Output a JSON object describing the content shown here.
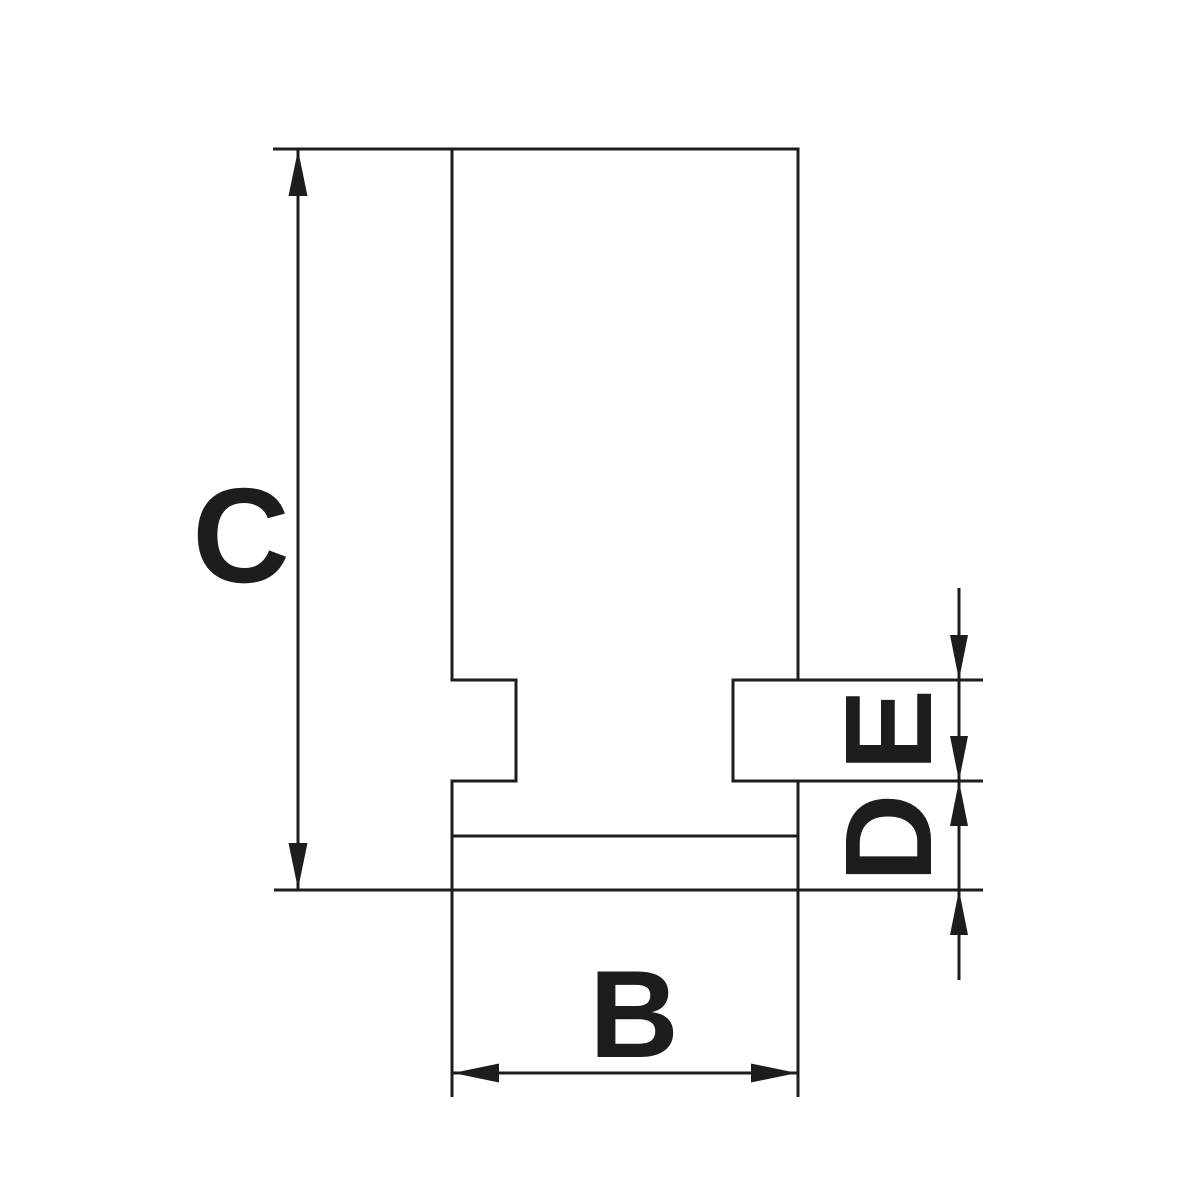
{
  "drawing": {
    "background_color": "#ffffff",
    "line_color": "#1d1d1b",
    "labels": {
      "c": "C",
      "b": "B",
      "e": "E",
      "d": "D"
    }
  }
}
